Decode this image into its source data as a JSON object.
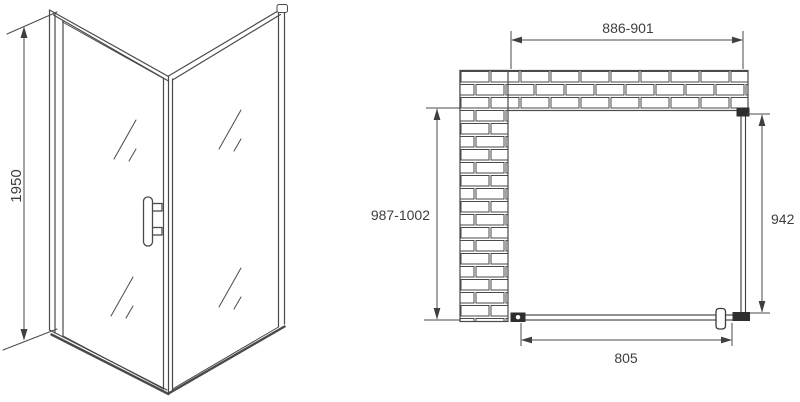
{
  "labels": {
    "height": "1950",
    "top_width": "886-901",
    "left_depth": "987-1002",
    "side_panel": "942",
    "door_width": "805"
  },
  "colors": {
    "line": "#4a4a4a",
    "dark_fitting": "#2e2e2e",
    "text": "#3f3f3f",
    "background": "#ffffff"
  }
}
